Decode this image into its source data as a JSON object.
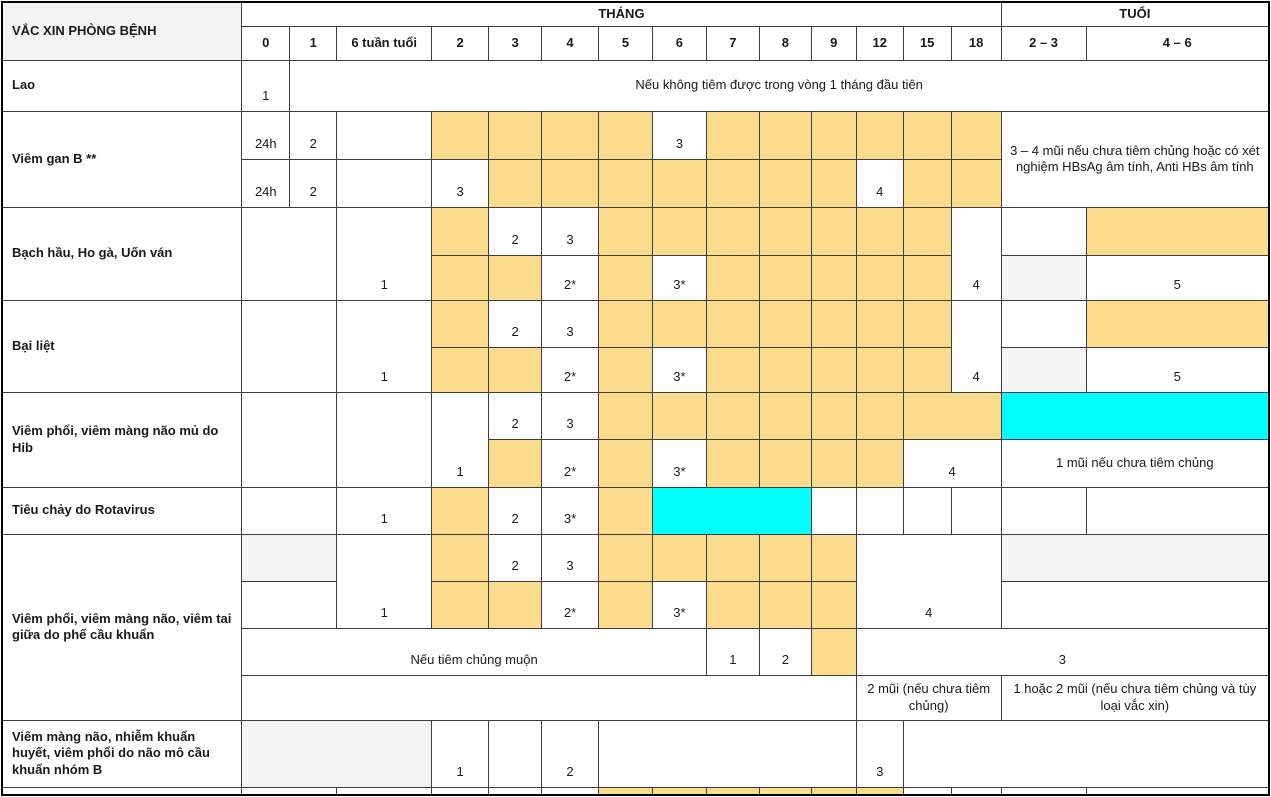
{
  "colors": {
    "dose_highlight": "#FBDC8C",
    "catchup_highlight": "#00FFFF",
    "muted_cell": "#F3F3F3",
    "border": "#3d3d3d"
  },
  "table": {
    "col_widths": [
      240,
      48,
      47,
      95,
      57,
      53,
      57,
      54,
      54,
      53,
      52,
      45,
      47,
      48,
      50,
      85,
      183
    ],
    "rows": [
      {
        "id": "header-top",
        "h": 24,
        "cells": [
          {
            "t": "VẮC XIN PHÒNG BỆNH",
            "rs": 2,
            "al": "lbl",
            "bg": "g",
            "n": "header-vaccine-column"
          },
          {
            "t": "THÁNG",
            "cs": 14,
            "al": "hdr",
            "n": "header-group-months"
          },
          {
            "t": "TUỔI",
            "cs": 2,
            "al": "hdr",
            "n": "header-group-age"
          }
        ]
      },
      {
        "id": "header-cols",
        "h": 34,
        "cells": [
          {
            "t": "0",
            "al": "hdr",
            "n": "header-month-0"
          },
          {
            "t": "1",
            "al": "hdr",
            "n": "header-month-1"
          },
          {
            "t": "6 tuần tuổi",
            "al": "hdr",
            "n": "header-6-weeks"
          },
          {
            "t": "2",
            "al": "hdr",
            "n": "header-month-2"
          },
          {
            "t": "3",
            "al": "hdr",
            "n": "header-month-3"
          },
          {
            "t": "4",
            "al": "hdr",
            "n": "header-month-4"
          },
          {
            "t": "5",
            "al": "hdr",
            "n": "header-month-5"
          },
          {
            "t": "6",
            "al": "hdr",
            "n": "header-month-6"
          },
          {
            "t": "7",
            "al": "hdr",
            "n": "header-month-7"
          },
          {
            "t": "8",
            "al": "hdr",
            "n": "header-month-8"
          },
          {
            "t": "9",
            "al": "hdr",
            "n": "header-month-9"
          },
          {
            "t": "12",
            "al": "hdr",
            "n": "header-month-12"
          },
          {
            "t": "15",
            "al": "hdr",
            "n": "header-month-15"
          },
          {
            "t": "18",
            "al": "hdr",
            "n": "header-month-18"
          },
          {
            "t": "2 – 3",
            "al": "hdr",
            "n": "header-age-2-3"
          },
          {
            "t": "4 – 6",
            "al": "hdr",
            "n": "header-age-4-6"
          }
        ]
      },
      {
        "id": "lao",
        "h": 51,
        "cells": [
          {
            "t": "Lao",
            "al": "lbl",
            "n": "row-label-lao"
          },
          {
            "t": "1",
            "al": "num",
            "n": "lao-dose-1"
          },
          {
            "t": "Nếu không tiêm được trong vòng 1 tháng đầu tiên",
            "cs": 15,
            "al": "mid",
            "n": "note-lao"
          }
        ]
      },
      {
        "id": "vgb-a",
        "h": 48,
        "cells": [
          {
            "t": "Viêm gan B **",
            "rs": 2,
            "al": "lbl",
            "n": "row-label-viem-gan-b"
          },
          {
            "t": "24h",
            "al": "num"
          },
          {
            "t": "2",
            "al": "num"
          },
          {},
          {
            "bg": "o"
          },
          {
            "bg": "o"
          },
          {
            "bg": "o"
          },
          {
            "bg": "o"
          },
          {
            "t": "3",
            "al": "num"
          },
          {
            "bg": "o"
          },
          {
            "bg": "o"
          },
          {
            "bg": "o"
          },
          {
            "bg": "o"
          },
          {
            "bg": "o"
          },
          {
            "bg": "o"
          },
          {
            "t": "3 – 4 mũi nếu chưa tiêm chủng hoặc có xét nghiệm HBsAg âm tính, Anti HBs âm tính",
            "cs": 2,
            "rs": 2,
            "al": "mid",
            "n": "note-hep-b"
          }
        ]
      },
      {
        "id": "vgb-b",
        "h": 48,
        "cells": [
          {
            "t": "24h",
            "al": "num"
          },
          {
            "t": "2",
            "al": "num"
          },
          {},
          {
            "t": "3",
            "al": "num"
          },
          {
            "bg": "o"
          },
          {
            "bg": "o"
          },
          {
            "bg": "o"
          },
          {
            "bg": "o"
          },
          {
            "bg": "o"
          },
          {
            "bg": "o"
          },
          {
            "bg": "o"
          },
          {
            "t": "4",
            "al": "num"
          },
          {
            "bg": "o"
          },
          {
            "bg": "o"
          }
        ]
      },
      {
        "id": "bachhau-a",
        "h": 48,
        "cells": [
          {
            "t": "Bạch hầu, Ho gà, Uốn ván",
            "rs": 2,
            "al": "lbl",
            "n": "row-label-bach-hau"
          },
          {
            "cs": 2,
            "rs": 2
          },
          {
            "t": "1",
            "rs": 2,
            "al": "num"
          },
          {
            "bg": "o"
          },
          {
            "t": "2",
            "al": "num"
          },
          {
            "t": "3",
            "al": "num"
          },
          {
            "bg": "o"
          },
          {
            "bg": "o"
          },
          {
            "bg": "o"
          },
          {
            "bg": "o"
          },
          {
            "bg": "o"
          },
          {
            "bg": "o"
          },
          {
            "bg": "o"
          },
          {
            "t": "4",
            "rs": 2,
            "al": "num"
          },
          {},
          {
            "bg": "o"
          }
        ]
      },
      {
        "id": "bachhau-b",
        "h": 45,
        "cells": [
          {
            "bg": "o"
          },
          {
            "bg": "o"
          },
          {
            "t": "2*",
            "al": "num"
          },
          {
            "bg": "o"
          },
          {
            "t": "3*",
            "al": "num"
          },
          {
            "bg": "o"
          },
          {
            "bg": "o"
          },
          {
            "bg": "o"
          },
          {
            "bg": "o"
          },
          {
            "bg": "o"
          },
          {
            "bg": "g"
          },
          {
            "t": "5",
            "al": "num"
          }
        ]
      },
      {
        "id": "bailiet-a",
        "h": 47,
        "cells": [
          {
            "t": "Bại liệt",
            "rs": 2,
            "al": "lbl",
            "n": "row-label-bai-liet"
          },
          {
            "cs": 2,
            "rs": 2
          },
          {
            "t": "1",
            "rs": 2,
            "al": "num"
          },
          {
            "bg": "o"
          },
          {
            "t": "2",
            "al": "num"
          },
          {
            "t": "3",
            "al": "num"
          },
          {
            "bg": "o"
          },
          {
            "bg": "o"
          },
          {
            "bg": "o"
          },
          {
            "bg": "o"
          },
          {
            "bg": "o"
          },
          {
            "bg": "o"
          },
          {
            "bg": "o"
          },
          {
            "t": "4",
            "rs": 2,
            "al": "num"
          },
          {},
          {
            "bg": "o"
          }
        ]
      },
      {
        "id": "bailiet-b",
        "h": 45,
        "cells": [
          {
            "bg": "o"
          },
          {
            "bg": "o"
          },
          {
            "t": "2*",
            "al": "num"
          },
          {
            "bg": "o"
          },
          {
            "t": "3*",
            "al": "num"
          },
          {
            "bg": "o"
          },
          {
            "bg": "o"
          },
          {
            "bg": "o"
          },
          {
            "bg": "o"
          },
          {
            "bg": "o"
          },
          {
            "bg": "g"
          },
          {
            "t": "5",
            "al": "num"
          }
        ]
      },
      {
        "id": "hib-a",
        "h": 47,
        "cells": [
          {
            "t": "Viêm phổi, viêm màng não mủ do Hib",
            "rs": 2,
            "al": "lbl",
            "n": "row-label-hib"
          },
          {
            "cs": 2,
            "rs": 2
          },
          {
            "rs": 2
          },
          {
            "t": "1",
            "rs": 2,
            "al": "num"
          },
          {
            "t": "2",
            "al": "num"
          },
          {
            "t": "3",
            "al": "num"
          },
          {
            "bg": "o"
          },
          {
            "bg": "o"
          },
          {
            "bg": "o"
          },
          {
            "bg": "o"
          },
          {
            "bg": "o"
          },
          {
            "bg": "o"
          },
          {
            "cs": 2,
            "bg": "o"
          },
          {
            "cs": 2,
            "bg": "c",
            "n": "highlight-hib-catchup"
          }
        ]
      },
      {
        "id": "hib-b",
        "h": 48,
        "cells": [
          {
            "bg": "o"
          },
          {
            "t": "2*",
            "al": "num"
          },
          {
            "bg": "o"
          },
          {
            "t": "3*",
            "al": "num"
          },
          {
            "bg": "o"
          },
          {
            "bg": "o"
          },
          {
            "bg": "o"
          },
          {
            "bg": "o"
          },
          {
            "t": "4",
            "cs": 2,
            "al": "num"
          },
          {
            "t": "1 mũi nếu chưa tiêm chủng",
            "cs": 2,
            "al": "mid",
            "n": "note-hib"
          }
        ]
      },
      {
        "id": "rota",
        "h": 47,
        "cells": [
          {
            "t": "Tiêu chảy do Rotavirus",
            "al": "lbl",
            "n": "row-label-rotavirus"
          },
          {
            "cs": 2
          },
          {
            "t": "1",
            "al": "num"
          },
          {
            "bg": "o"
          },
          {
            "t": "2",
            "al": "num"
          },
          {
            "t": "3*",
            "al": "num"
          },
          {
            "bg": "o"
          },
          {
            "cs": 3,
            "bg": "c",
            "n": "highlight-rota-window"
          },
          {},
          {},
          {},
          {},
          {},
          {}
        ]
      },
      {
        "id": "phecau-a",
        "h": 47,
        "cells": [
          {
            "t": "Viêm phổi, viêm màng não, viêm tai giữa do phế cầu khuẩn",
            "rs": 4,
            "al": "lbl",
            "n": "row-label-phe-cau"
          },
          {
            "cs": 2,
            "bg": "g"
          },
          {
            "t": "1",
            "rs": 2,
            "al": "num"
          },
          {
            "bg": "o"
          },
          {
            "t": "2",
            "al": "num"
          },
          {
            "t": "3",
            "al": "num"
          },
          {
            "bg": "o"
          },
          {
            "bg": "o"
          },
          {
            "bg": "o"
          },
          {
            "bg": "o"
          },
          {
            "bg": "o"
          },
          {
            "t": "4",
            "cs": 3,
            "rs": 2,
            "al": "num"
          },
          {
            "cs": 2,
            "bg": "g"
          }
        ]
      },
      {
        "id": "phecau-b",
        "h": 47,
        "cells": [
          {
            "cs": 2
          },
          {
            "bg": "o"
          },
          {
            "bg": "o"
          },
          {
            "t": "2*",
            "al": "num"
          },
          {
            "bg": "o"
          },
          {
            "t": "3*",
            "al": "num"
          },
          {
            "bg": "o"
          },
          {
            "bg": "o"
          },
          {
            "bg": "o"
          },
          {
            "cs": 2
          }
        ]
      },
      {
        "id": "phecau-c",
        "h": 47,
        "cells": [
          {
            "t": "Nếu tiêm chủng muộn",
            "cs": 8,
            "al": "num",
            "n": "note-phe-cau-late"
          },
          {
            "t": "1",
            "al": "num"
          },
          {
            "t": "2",
            "al": "num"
          },
          {
            "bg": "o"
          },
          {
            "t": "3",
            "cs": 5,
            "al": "num"
          }
        ]
      },
      {
        "id": "phecau-d",
        "h": 45,
        "cells": [
          {
            "cs": 11
          },
          {
            "t": "2 mũi (nếu chưa tiêm chủng)",
            "cs": 3,
            "al": "mid",
            "n": "note-phe-cau-2-doses"
          },
          {
            "t": "1 hoặc 2 mũi (nếu chưa tiêm chủng và tùy loại vắc xin)",
            "cs": 2,
            "al": "mid",
            "n": "note-phe-cau-1-2-doses"
          }
        ]
      },
      {
        "id": "naomocau-b",
        "h": 67,
        "cells": [
          {
            "t": "Viêm màng não, nhiễm khuẩn huyết, viêm phổi do não mô cầu khuẩn nhóm B",
            "al": "lbl",
            "n": "row-label-nao-mo-cau-b"
          },
          {
            "cs": 3,
            "bg": "g"
          },
          {
            "t": "1",
            "al": "num"
          },
          {},
          {
            "t": "2",
            "al": "num"
          },
          {
            "cs": 5
          },
          {
            "t": "3",
            "al": "num"
          },
          {
            "cs": 4
          }
        ]
      },
      {
        "id": "cutoff",
        "h": 6,
        "cells": [
          {},
          {
            "cs": 2
          },
          {},
          {},
          {},
          {},
          {
            "bg": "o"
          },
          {
            "bg": "o"
          },
          {
            "bg": "o"
          },
          {
            "bg": "o"
          },
          {
            "bg": "o"
          },
          {
            "bg": "o"
          },
          {},
          {},
          {},
          {}
        ]
      }
    ]
  }
}
